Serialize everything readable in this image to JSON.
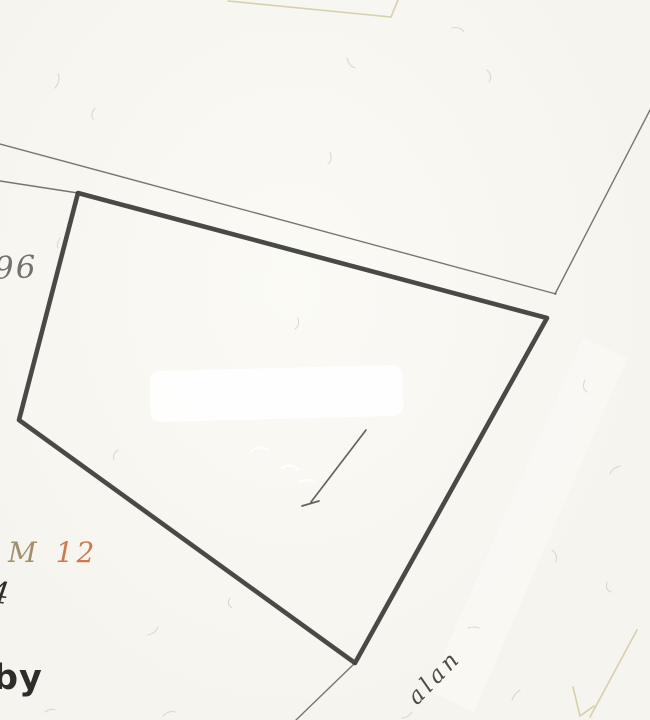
{
  "map": {
    "description_labels": {
      "left_parcel_number": "96",
      "block_label_prefix": "M",
      "block_label_number": "12",
      "partial_number": "4",
      "partial_word": "by",
      "road_name_partial": "alan"
    },
    "colors": {
      "paper": "#f6f4ee",
      "paper_light": "#fbfaf5",
      "boundary": "#3b3a36",
      "thin_line": "#57554f",
      "tan_line": "#d6cca6",
      "label_gray": "#72726e",
      "label_m": "#a48f6c",
      "label_orange": "#cb7a50",
      "label_dark": "#2e2d2a",
      "road_text": "#4d4c47",
      "white_patch": "#ffffff"
    },
    "geometry": {
      "parcel_polygon": "78,193 547,318 355,663 19,420",
      "road_edge_upper": "0,144 556,294",
      "road_edge_inner": "0,181 78,193",
      "road_edge_right": "650,110 555,294",
      "boundary_extension": "355,663 296,720",
      "adjacent_outline_top": "228,1 391,17 398,0",
      "faint_outline_a": "573,687 580,716 594,706",
      "faint_outline_b": "590,717 637,630",
      "pen_mark_path": "M366,430 L311,502 M302,506 L319,501",
      "road_band": "583,338 627,358 474,712 428,690"
    }
  }
}
